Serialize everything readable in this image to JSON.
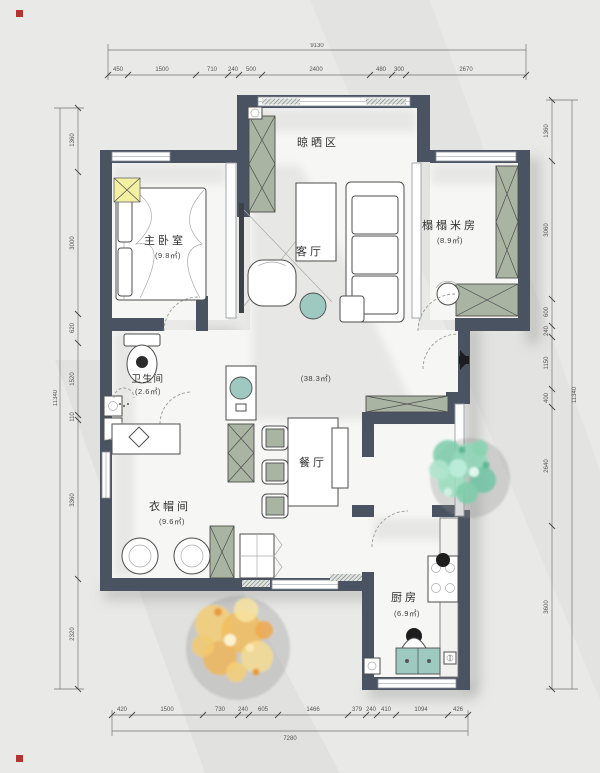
{
  "colors": {
    "wall": "#4a5361",
    "background": "#e9e9e7",
    "floor": "#f6f6f4",
    "cabinet_green": "#a9b4a2",
    "basin_teal": "#9ec9c0",
    "ac_yellow": "#f3f0a2",
    "tree_green": "#7ccdaa",
    "tree_yellow": "#f1bd5e",
    "corner_marker_red": "#b23430"
  },
  "rooms": {
    "drying": {
      "name": "晾晒区"
    },
    "master": {
      "name": "主卧室",
      "area": "(9.8㎡)"
    },
    "tatami": {
      "name": "榻榻米房",
      "area": "(8.9㎡)"
    },
    "living": {
      "name": "客厅"
    },
    "overall": {
      "area": "(38.3㎡)"
    },
    "dining": {
      "name": "餐厅"
    },
    "bath": {
      "name": "卫生间",
      "area": "(2.6㎡)"
    },
    "cloak": {
      "name": "衣帽间",
      "area": "(9.6㎡)"
    },
    "kitchen": {
      "name": "厨房",
      "area": "(6.9㎡)"
    }
  },
  "dims": {
    "top": {
      "total": "9130",
      "segments": [
        "450",
        "1500",
        "710",
        "240",
        "500",
        "2400",
        "480",
        "300",
        "2670"
      ]
    },
    "bottom": {
      "total": "7280",
      "segments": [
        "420",
        "1500",
        "730",
        "240",
        "605",
        "1466",
        "379",
        "240",
        "410",
        "1094",
        "426"
      ]
    },
    "left": {
      "total": "11340",
      "segments": [
        "1360",
        "3000",
        "620",
        "1520",
        "110",
        "3360",
        "2320"
      ]
    },
    "right": {
      "total": "11340",
      "segments": [
        "1360",
        "3060",
        "600",
        "240",
        "1150",
        "400",
        "2640",
        "3600"
      ]
    }
  }
}
